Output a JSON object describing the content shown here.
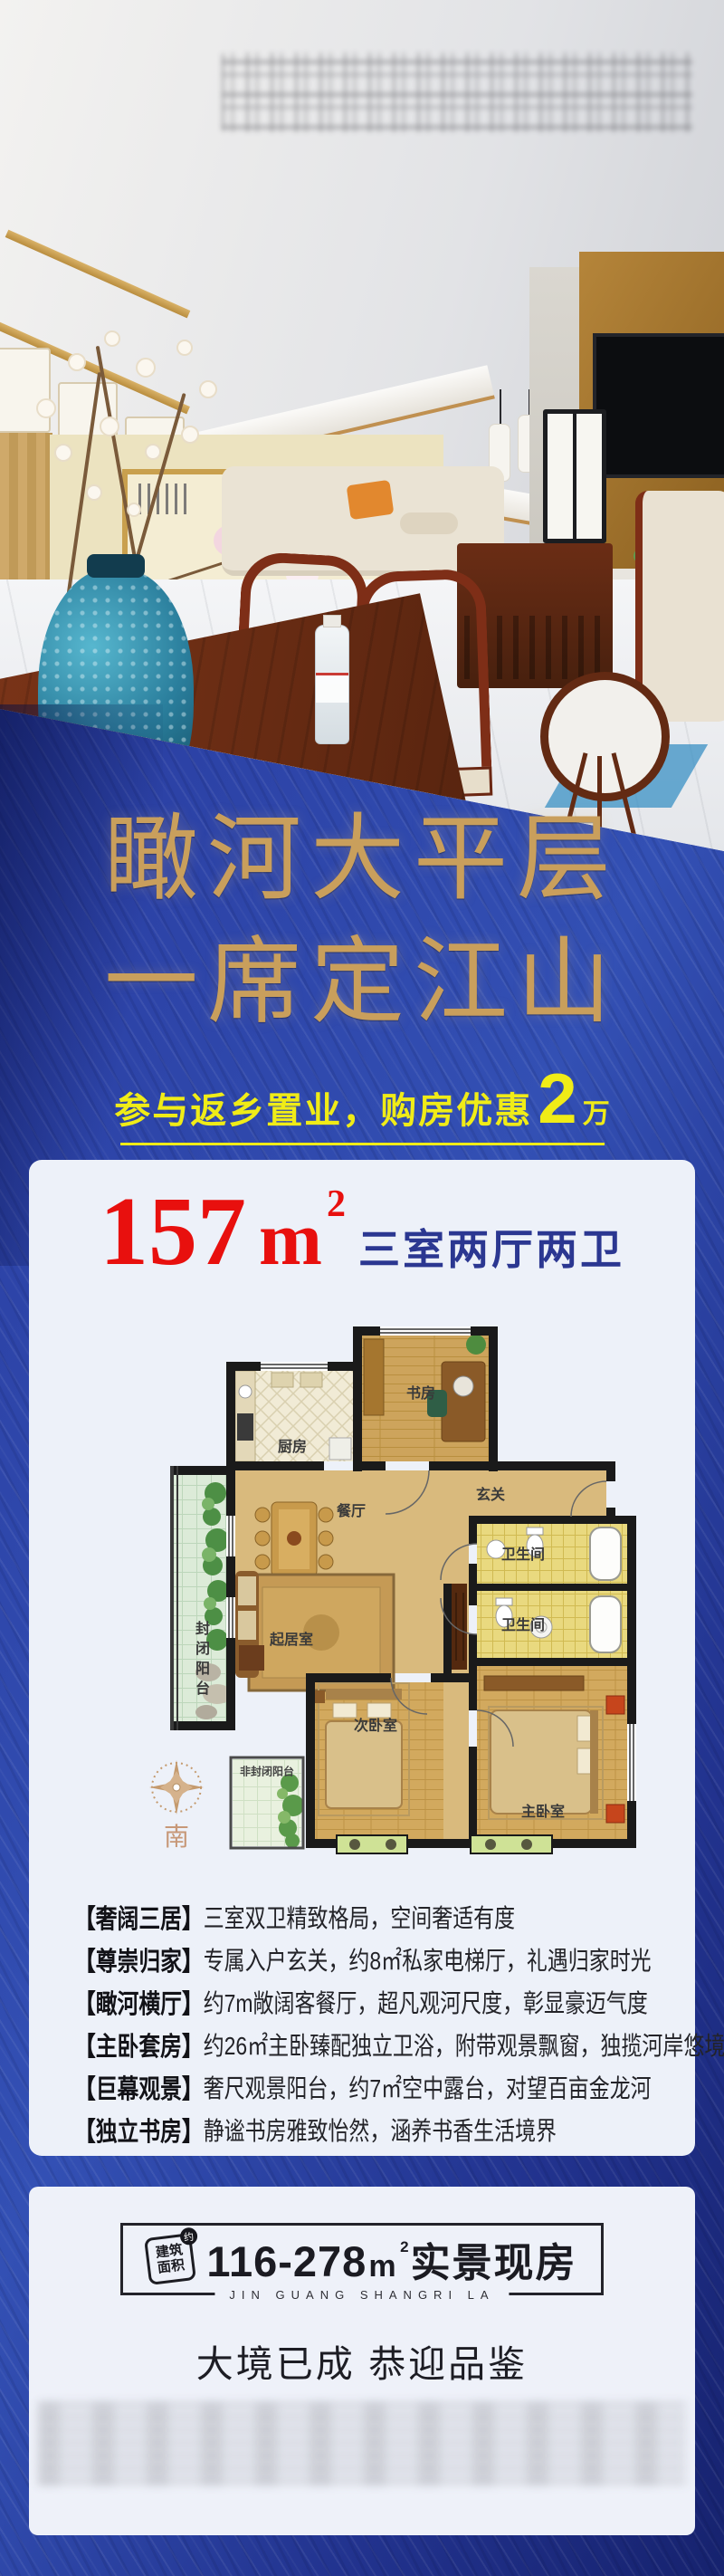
{
  "headline": {
    "line1": "瞰河大平层",
    "line2": "一席定江山"
  },
  "promo": {
    "text": "参与返乡置业，购房优惠",
    "highlight": "2",
    "unit": "万"
  },
  "unit_card": {
    "area": "157",
    "area_unit_base": "m",
    "area_unit_exp": "2",
    "layout": "三室两厅两卫"
  },
  "floorplan": {
    "labels": {
      "kitchen": "厨房",
      "study": "书房",
      "dining": "餐厅",
      "entry": "玄关",
      "bath_upper": "卫生间",
      "bath_lower": "卫生间",
      "living": "起居室",
      "balcony_enclosed": "封闭阳台",
      "balcony_open": "非封闭阳台",
      "bedroom_second": "次卧室",
      "bedroom_master": "主卧室",
      "south": "南"
    }
  },
  "features": [
    {
      "tag": "【奢阔三居】",
      "desc": "三室双卫精致格局，空间奢适有度"
    },
    {
      "tag": "【尊崇归家】",
      "desc": "专属入户玄关，约8㎡私家电梯厅，礼遇归家时光"
    },
    {
      "tag": "【瞰河横厅】",
      "desc": "约7m敞阔客餐厅，超凡观河尺度，彰显豪迈气度"
    },
    {
      "tag": "【主卧套房】",
      "desc": "约26㎡主卧臻配独立卫浴，附带观景飘窗，独揽河岸悠境"
    },
    {
      "tag": "【巨幕观景】",
      "desc": "奢尺观景阳台，约7㎡空中露台，对望百亩金龙河"
    },
    {
      "tag": "【独立书房】",
      "desc": "静谧书房雅致怡然，涵养书香生活境界"
    }
  ],
  "footer": {
    "stamp_top": "建筑",
    "stamp_bottom": "面积",
    "stamp_badge": "约",
    "range": "116-278",
    "range_unit_base": "m",
    "range_unit_exp": "2",
    "range_label": "实景现房",
    "latin": "JIN GUANG SHANGRI LA",
    "closing": "大境已成 恭迎品鉴"
  },
  "colors": {
    "gold": "#c99f5c",
    "promo_yellow": "#f0ec17",
    "accent_red": "#e8100e",
    "navy_text": "#2b3791",
    "blue_background": "#2742a3",
    "card_background": "#edf1f9"
  }
}
